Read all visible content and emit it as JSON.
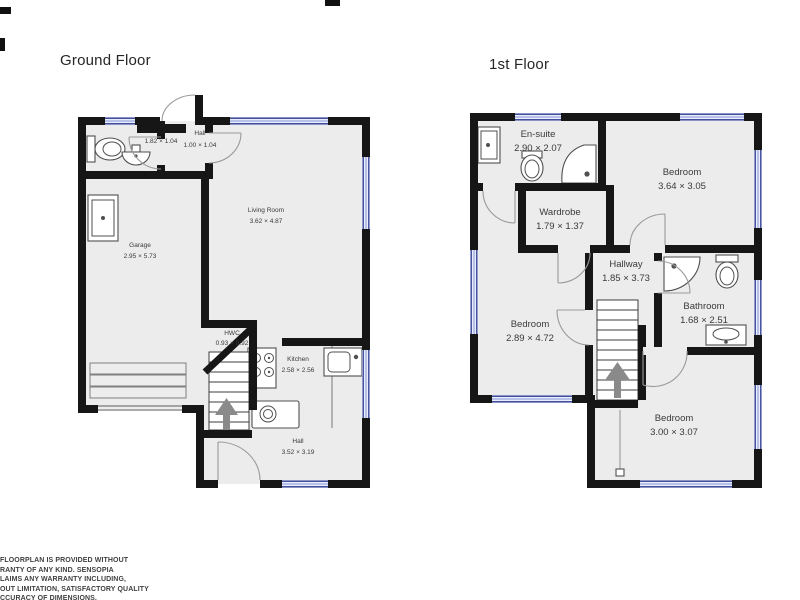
{
  "titles": {
    "ground": "Ground Floor",
    "first": "1st Floor"
  },
  "ground_floor": {
    "rooms": [
      {
        "name": "Toilet",
        "dims": "1.82 × 1.04"
      },
      {
        "name": "Hall",
        "dims": "1.00 × 1.04"
      },
      {
        "name": "Garage",
        "dims": "2.95 × 5.73"
      },
      {
        "name": "Living Room",
        "dims": "3.62 × 4.87"
      },
      {
        "name": "HWC",
        "dims": "0.93 × 0.92"
      },
      {
        "name": "Kitchen",
        "dims": "2.58 × 2.56"
      },
      {
        "name": "Hall",
        "dims": "3.52 × 3.19"
      }
    ]
  },
  "first_floor": {
    "rooms": [
      {
        "name": "En-suite",
        "dims": "2.90 × 2.07"
      },
      {
        "name": "Wardrobe",
        "dims": "1.79 × 1.37"
      },
      {
        "name": "Bedroom",
        "dims": "3.64 × 3.05"
      },
      {
        "name": "Hallway",
        "dims": "1.85 × 3.73"
      },
      {
        "name": "Bathroom",
        "dims": "1.68 × 2.51"
      },
      {
        "name": "Bedroom",
        "dims": "2.89 × 4.72"
      },
      {
        "name": "Bedroom",
        "dims": "3.00 × 3.07"
      }
    ]
  },
  "disclaimer": {
    "lines": [
      "FLOORPLAN IS PROVIDED WITHOUT",
      "RANTY OF ANY KIND. SENSOPIA",
      "LAIMS ANY WARRANTY INCLUDING,",
      "OUT LIMITATION, SATISFACTORY QUALITY",
      "CCURACY OF DIMENSIONS."
    ]
  },
  "colors": {
    "wall": "#161616",
    "floor": "#ececec",
    "window_line": "#2b3990",
    "window_fill": "#e9edf9",
    "door_arc": "#9a9a9a",
    "stairs_arrow": "#8a8a8a",
    "label_text": "#3a3a3a"
  }
}
